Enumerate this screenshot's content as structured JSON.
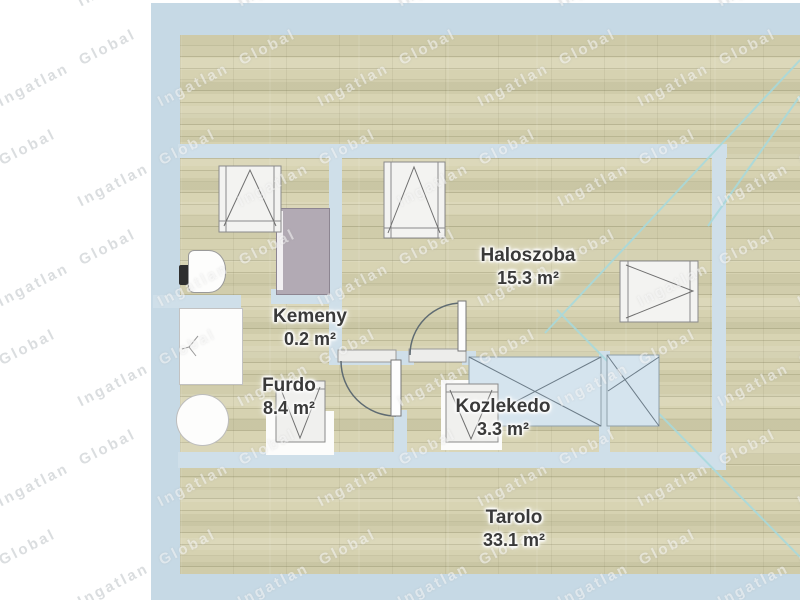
{
  "watermark": {
    "text": "Ingatlan Global"
  },
  "rooms": [
    {
      "id": "haloszoba",
      "name": "Haloszoba",
      "area": "15.3 m²"
    },
    {
      "id": "kemeny",
      "name": "Kemeny",
      "area": "0.2 m²"
    },
    {
      "id": "furdo",
      "name": "Furdo",
      "area": "8.4 m²"
    },
    {
      "id": "kozlekedo",
      "name": "Kozlekedo",
      "area": "3.3 m²"
    },
    {
      "id": "tarolo",
      "name": "Tarolo",
      "area": "33.1 m²"
    }
  ],
  "colors": {
    "outer_wall": "#c6d9e5",
    "inner_wall": "#cfdfe9",
    "skylight_fill": "#d5e4ee",
    "skylight_stroke": "#8fa0ab",
    "roof_line": "#a6dade",
    "label_text": "#3a3a3a",
    "window_stroke": "#8a8a8a",
    "symbol_stroke": "#6f6f6f"
  }
}
